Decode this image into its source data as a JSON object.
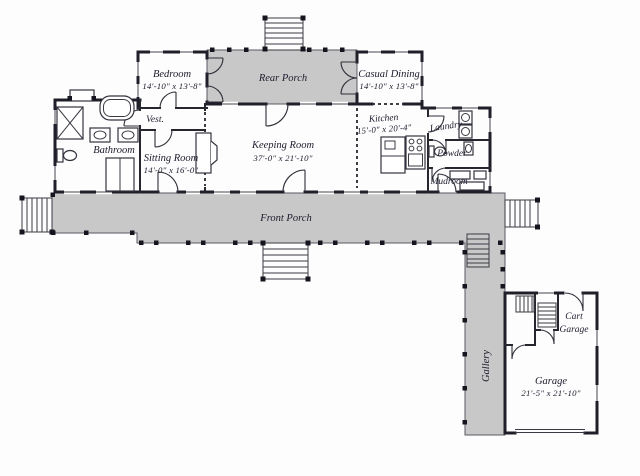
{
  "plan": {
    "title": "First floor plan",
    "rooms": {
      "bedroom": {
        "name": "Bedroom",
        "dims": "14'-10\" x 13'-8\""
      },
      "rear_porch": {
        "name": "Rear Porch"
      },
      "casual_dining": {
        "name": "Casual Dining",
        "dims": "14'-10\" x 13'-8\""
      },
      "vestibule": {
        "name": "Vest."
      },
      "bathroom": {
        "name": "Bathroom"
      },
      "sitting_room": {
        "name": "Sitting Room",
        "dims": "14'-0\" x 16'-0\""
      },
      "keeping_room": {
        "name": "Keeping Room",
        "dims": "37'-0\" x 21'-10\""
      },
      "kitchen": {
        "name": "Kitchen",
        "dims": "15'-0\" x 20'-4\""
      },
      "laundry": {
        "name": "Laundry"
      },
      "powder": {
        "name": "Powder"
      },
      "mudroom": {
        "name": "Mudroom"
      },
      "front_porch": {
        "name": "Front Porch"
      },
      "gallery": {
        "name": "Gallery"
      },
      "cart_garage": {
        "name_line1": "Cart",
        "name_line2": "Garage"
      },
      "garage": {
        "name": "Garage",
        "dims": "21'-5\" x 21'-10\""
      }
    },
    "colors": {
      "porch_fill": "#c8c8c8",
      "wall": "#1f1f2a",
      "label": "#1c1c2e",
      "background": "#fdfdfd"
    }
  }
}
